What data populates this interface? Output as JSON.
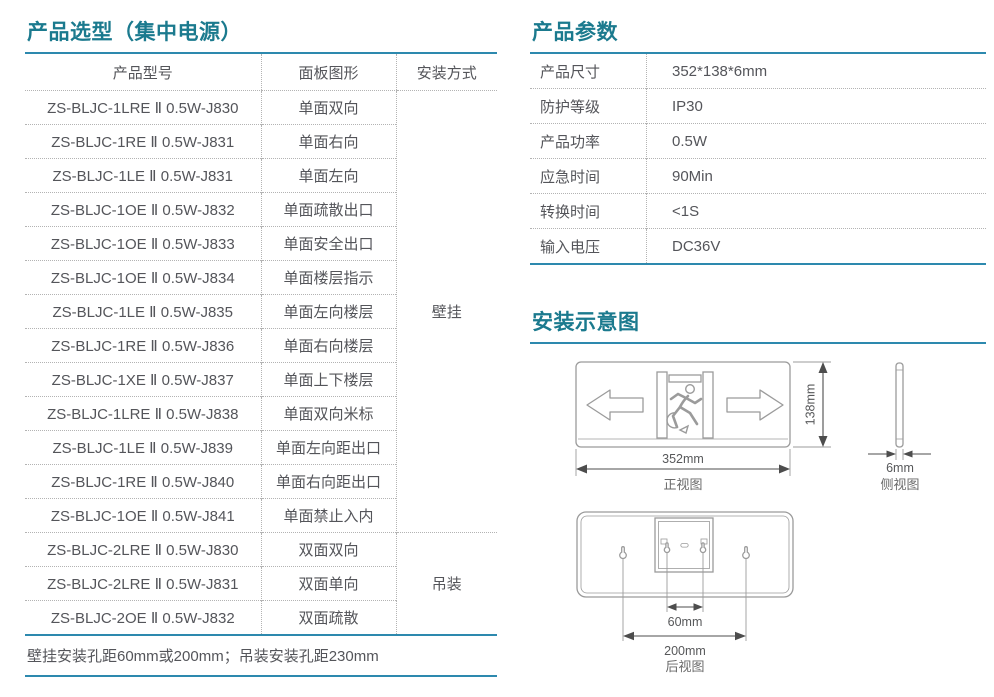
{
  "colors": {
    "title_teal": "#1b7a8e",
    "rule_blue": "#2d89ae",
    "body_text": "#54555a",
    "diagram_gray": "#9b9b9b"
  },
  "selection": {
    "title": "产品选型（集中电源）",
    "col_model": "产品型号",
    "col_panel": "面板图形",
    "col_mount": "安装方式",
    "rows": [
      {
        "model": "ZS-BLJC-1LRE Ⅱ 0.5W-J830",
        "panel": "单面双向"
      },
      {
        "model": "ZS-BLJC-1RE Ⅱ 0.5W-J831",
        "panel": "单面右向"
      },
      {
        "model": "ZS-BLJC-1LE Ⅱ 0.5W-J831",
        "panel": "单面左向"
      },
      {
        "model": "ZS-BLJC-1OE Ⅱ 0.5W-J832",
        "panel": "单面疏散出口"
      },
      {
        "model": "ZS-BLJC-1OE Ⅱ 0.5W-J833",
        "panel": "单面安全出口"
      },
      {
        "model": "ZS-BLJC-1OE Ⅱ 0.5W-J834",
        "panel": "单面楼层指示"
      },
      {
        "model": "ZS-BLJC-1LE Ⅱ 0.5W-J835",
        "panel": "单面左向楼层"
      },
      {
        "model": "ZS-BLJC-1RE Ⅱ 0.5W-J836",
        "panel": "单面右向楼层"
      },
      {
        "model": "ZS-BLJC-1XE Ⅱ 0.5W-J837",
        "panel": "单面上下楼层"
      },
      {
        "model": "ZS-BLJC-1LRE Ⅱ 0.5W-J838",
        "panel": "单面双向米标"
      },
      {
        "model": "ZS-BLJC-1LE Ⅱ 0.5W-J839",
        "panel": "单面左向距出口"
      },
      {
        "model": "ZS-BLJC-1RE Ⅱ 0.5W-J840",
        "panel": "单面右向距出口"
      },
      {
        "model": "ZS-BLJC-1OE Ⅱ 0.5W-J841",
        "panel": "单面禁止入内"
      },
      {
        "model": "ZS-BLJC-2LRE Ⅱ 0.5W-J830",
        "panel": "双面双向"
      },
      {
        "model": "ZS-BLJC-2LRE Ⅱ 0.5W-J831",
        "panel": "双面单向"
      },
      {
        "model": "ZS-BLJC-2OE Ⅱ 0.5W-J832",
        "panel": "双面疏散"
      }
    ],
    "mount_wall": "壁挂",
    "mount_ceiling": "吊装",
    "footnote": "壁挂安装孔距60mm或200mm；吊装安装孔距230mm"
  },
  "params": {
    "title": "产品参数",
    "rows": [
      {
        "label": "产品尺寸",
        "value": "352*138*6mm"
      },
      {
        "label": "防护等级",
        "value": "IP30"
      },
      {
        "label": "产品功率",
        "value": "0.5W"
      },
      {
        "label": "应急时间",
        "value": "90Min"
      },
      {
        "label": "转换时间",
        "value": "<1S"
      },
      {
        "label": "输入电压",
        "value": "DC36V"
      }
    ]
  },
  "diagram": {
    "title": "安装示意图",
    "front_width": "352mm",
    "front_height": "138mm",
    "front_caption": "正视图",
    "side_thickness": "6mm",
    "side_caption": "侧视图",
    "rear_hole_inner": "60mm",
    "rear_hole_outer": "200mm",
    "rear_caption": "后视图"
  }
}
